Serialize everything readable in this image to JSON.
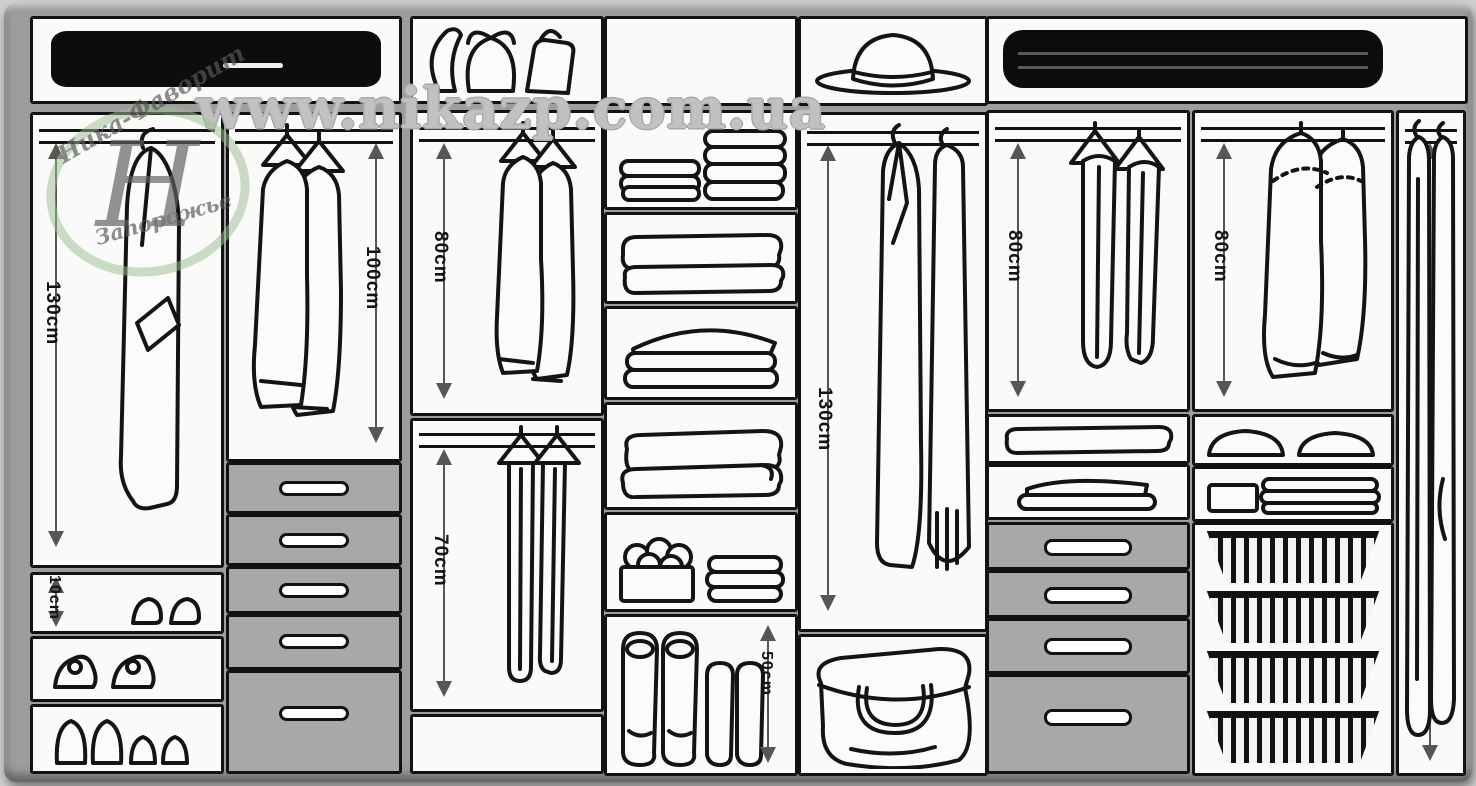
{
  "watermark": "www.nikazp.com.ua",
  "logo": {
    "line1": "Ника-Фаворит",
    "monogram": "Н",
    "line2": "Запорожье"
  },
  "measurements": {
    "left_coat_height": "130cm",
    "shoe_shelf_height": "10cm",
    "jacket_height": "100cm",
    "shirt_height": "80cm",
    "trouser_height": "70cm",
    "boot_height": "50cm",
    "long_garment_height": "130cm",
    "draped_trouser_height": "80cm",
    "sweater_height": "80cm",
    "dress_height": "180cm"
  },
  "illustrations": {
    "garment_case": "black garment case on top shelf",
    "bags": "handbags and backpack on top shelf",
    "hat": "fedora hat on top shelf",
    "suitcase": "black suitcase on top shelf",
    "coat": "long coat on hook",
    "jackets": "two coats on hangers",
    "shirts": "two shirts on hangers",
    "hanging_trousers": "trousers hanging full length",
    "draped_trousers": "trousers draped over hangers",
    "sweaters": "two sweaters on hangers",
    "dresses": "two long dresses on hangers",
    "folded_stacks": "stacks of folded clothes",
    "blankets": "folded blankets",
    "socks_box": "box of rolled socks",
    "boots": "two pairs of boots",
    "large_bag": "large soft bag",
    "shoes": "pairs of shoes",
    "baskets": "wire pull-out baskets",
    "drawers": "closed drawers with handles"
  },
  "colors": {
    "carcass": "#9d9d9d",
    "compartment": "#fafaf8",
    "ink": "#121212",
    "drawer": "#a8a8a8",
    "arrow": "#565656",
    "logo_green": "#9dbf92",
    "watermark": "#a9a9a9"
  }
}
